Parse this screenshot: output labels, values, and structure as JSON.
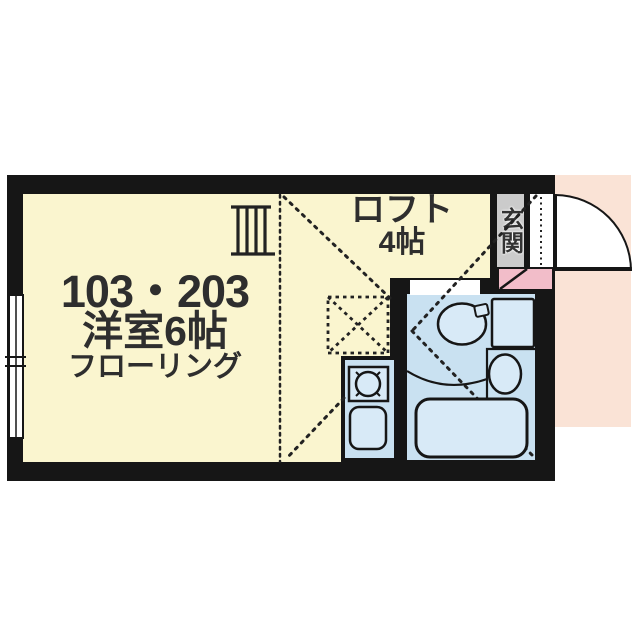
{
  "floorplan": {
    "unit_label": "103・203",
    "room_label": "洋室6帖",
    "flooring_label": "フローリング",
    "loft_label": "ロフト",
    "loft_size_label": "4帖",
    "entrance_label": "玄関",
    "colors": {
      "wall": "#161616",
      "room_floor": "#faf5cf",
      "wet_area_floor": "#c9e1f1",
      "fixture_fill": "#d8eaf7",
      "outside_entry_highlight": "#fae3d6",
      "entrance_floor": "#cbcbcb",
      "entrance_step": "#f2bdc9",
      "label_text": "#2e2e2e"
    }
  }
}
